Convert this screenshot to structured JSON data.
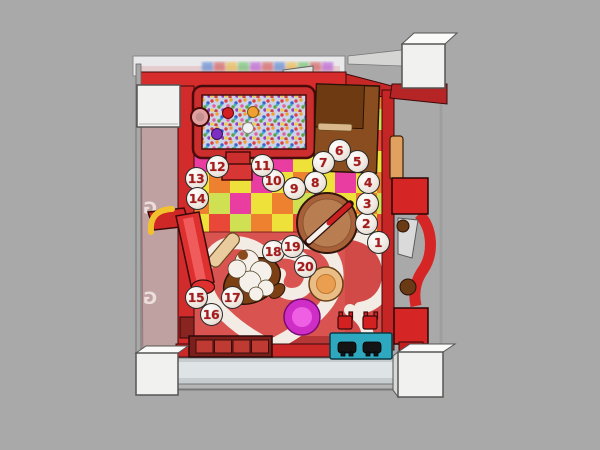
{
  "markers": [
    "1",
    "2",
    "3",
    "4",
    "5",
    "6",
    "7",
    "8",
    "9",
    "10",
    "11",
    "12",
    "13",
    "14",
    "15",
    "16",
    "17",
    "18",
    "19",
    "20"
  ],
  "wall": {
    "letters": [
      "G",
      "G"
    ]
  },
  "palette": {
    "background": "#a9a9a9",
    "frame_red": "#cf2a2a",
    "floor_red": "#d95450",
    "heart_white": "#f3ece4",
    "checker": [
      "#eee23a",
      "#ee8130",
      "#e93da2",
      "#cfe153",
      "#e94838",
      "#f2aebc"
    ],
    "corner_cube": "#f1f1ef",
    "bed_brown": "#8a4d1f",
    "table_brown": "#b0744a",
    "donut_tan": "#e9bd83",
    "donut_pink": "#cf2ec6",
    "bench_teal": "#2ea8bf",
    "pool_balls": [
      "#d42020",
      "#f0a030",
      "#f2f2f2",
      "#7c2fc0"
    ]
  }
}
